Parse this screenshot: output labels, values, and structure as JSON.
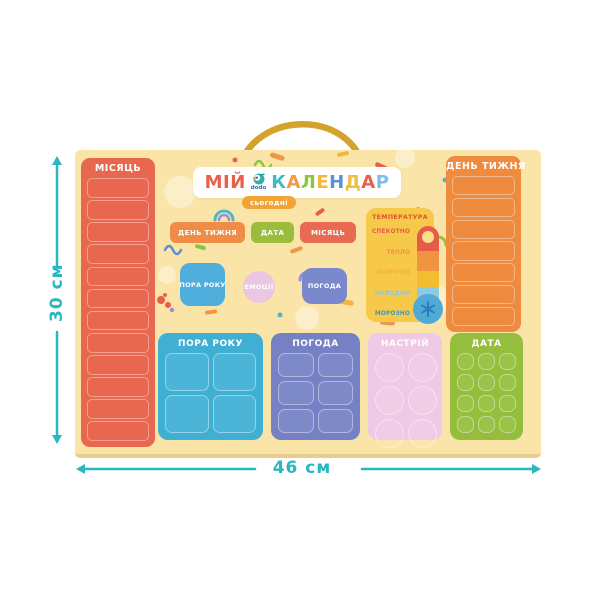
{
  "annotations": {
    "height_label": "30 см",
    "width_label": "46 см",
    "accent_color": "#2BB7BF"
  },
  "title": {
    "part1": "МІЙ",
    "part1_color": "#E8604C",
    "brand": "dodo",
    "brand_color": "#2B6CB8",
    "letters": [
      {
        "ch": "К",
        "color": "#45B8C8"
      },
      {
        "ch": "А",
        "color": "#F09A44"
      },
      {
        "ch": "Л",
        "color": "#8CC63F"
      },
      {
        "ch": "Е",
        "color": "#F5B63F"
      },
      {
        "ch": "Н",
        "color": "#5B8FD6"
      },
      {
        "ch": "Д",
        "color": "#F0C040"
      },
      {
        "ch": "А",
        "color": "#E8604C"
      },
      {
        "ch": "Р",
        "color": "#7FBDE8"
      }
    ],
    "today_badge": "сьогодні",
    "today_badge_color": "#F2A437"
  },
  "month_panel": {
    "label": "МІСЯЦЬ",
    "slot_count": 12,
    "color": "#E8674F"
  },
  "weekday_panel": {
    "label": "ДЕНЬ ТИЖНЯ",
    "slot_count": 7,
    "color": "#EF8B3F"
  },
  "tag_buttons": [
    {
      "label": "ДЕНЬ ТИЖНЯ",
      "color": "#F08C45"
    },
    {
      "label": "ДАТА",
      "color": "#9ABD3D"
    },
    {
      "label": "МІСЯЦЬ",
      "color": "#E86A52"
    }
  ],
  "token_cards": [
    {
      "label": "ПОРА РОКУ",
      "color": "#4FAEDC",
      "shape": "square"
    },
    {
      "label": "ЕМОЦІЇ",
      "color": "#EBC7E4",
      "shape": "circle"
    },
    {
      "label": "ПОГОДА",
      "color": "#7989CC",
      "shape": "square"
    }
  ],
  "temperature": {
    "title": "ТЕМПЕРАТУРА",
    "panel_color": "#F6C94A",
    "title_color": "#D9572B",
    "levels": [
      {
        "label": "СПЕКОТНО",
        "color": "#E65C48"
      },
      {
        "label": "ТЕПЛО",
        "color": "#F0923F"
      },
      {
        "label": "ПОМІРНО",
        "color": "#F3B32B"
      },
      {
        "label": "ХОЛОДНО",
        "color": "#8CC8DE"
      },
      {
        "label": "МОРОЗНО",
        "color": "#3F97C8"
      }
    ]
  },
  "bottom_panels": [
    {
      "label": "ПОРА РОКУ",
      "color": "#3FAFD4",
      "cells": 4,
      "cols": 2,
      "cell_shape": "square"
    },
    {
      "label": "ПОГОДА",
      "color": "#7581C4",
      "cells": 6,
      "cols": 2,
      "cell_shape": "square"
    },
    {
      "label": "НАСТРІЙ",
      "color": "#EFC9E6",
      "cells": 6,
      "cols": 2,
      "cell_shape": "circle"
    },
    {
      "label": "ДАТА",
      "color": "#94BE3C",
      "cells": 12,
      "cols": 3,
      "cell_shape": "square"
    }
  ]
}
